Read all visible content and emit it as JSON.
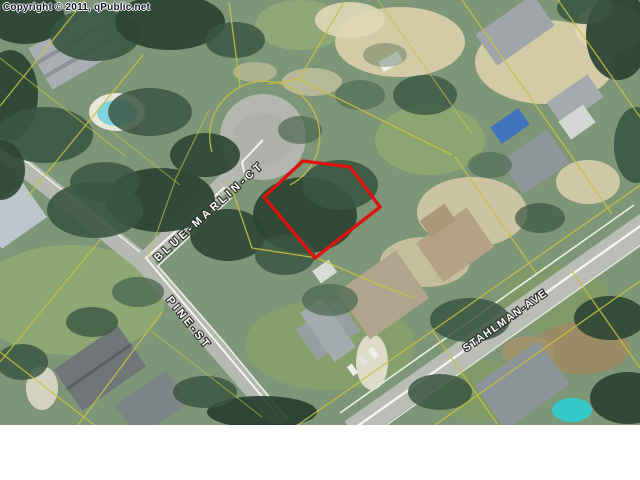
{
  "map": {
    "copyright": "Copyright © 2011, qPublic.net",
    "labels": {
      "blue_marlin": "BLUE-MARLIN-CT",
      "pine": "PINE-ST",
      "stahlman": "STAHLMAN-AVE"
    },
    "colors": {
      "selected_parcel": "#dc1410",
      "parcel_line": "#c8c140"
    }
  }
}
